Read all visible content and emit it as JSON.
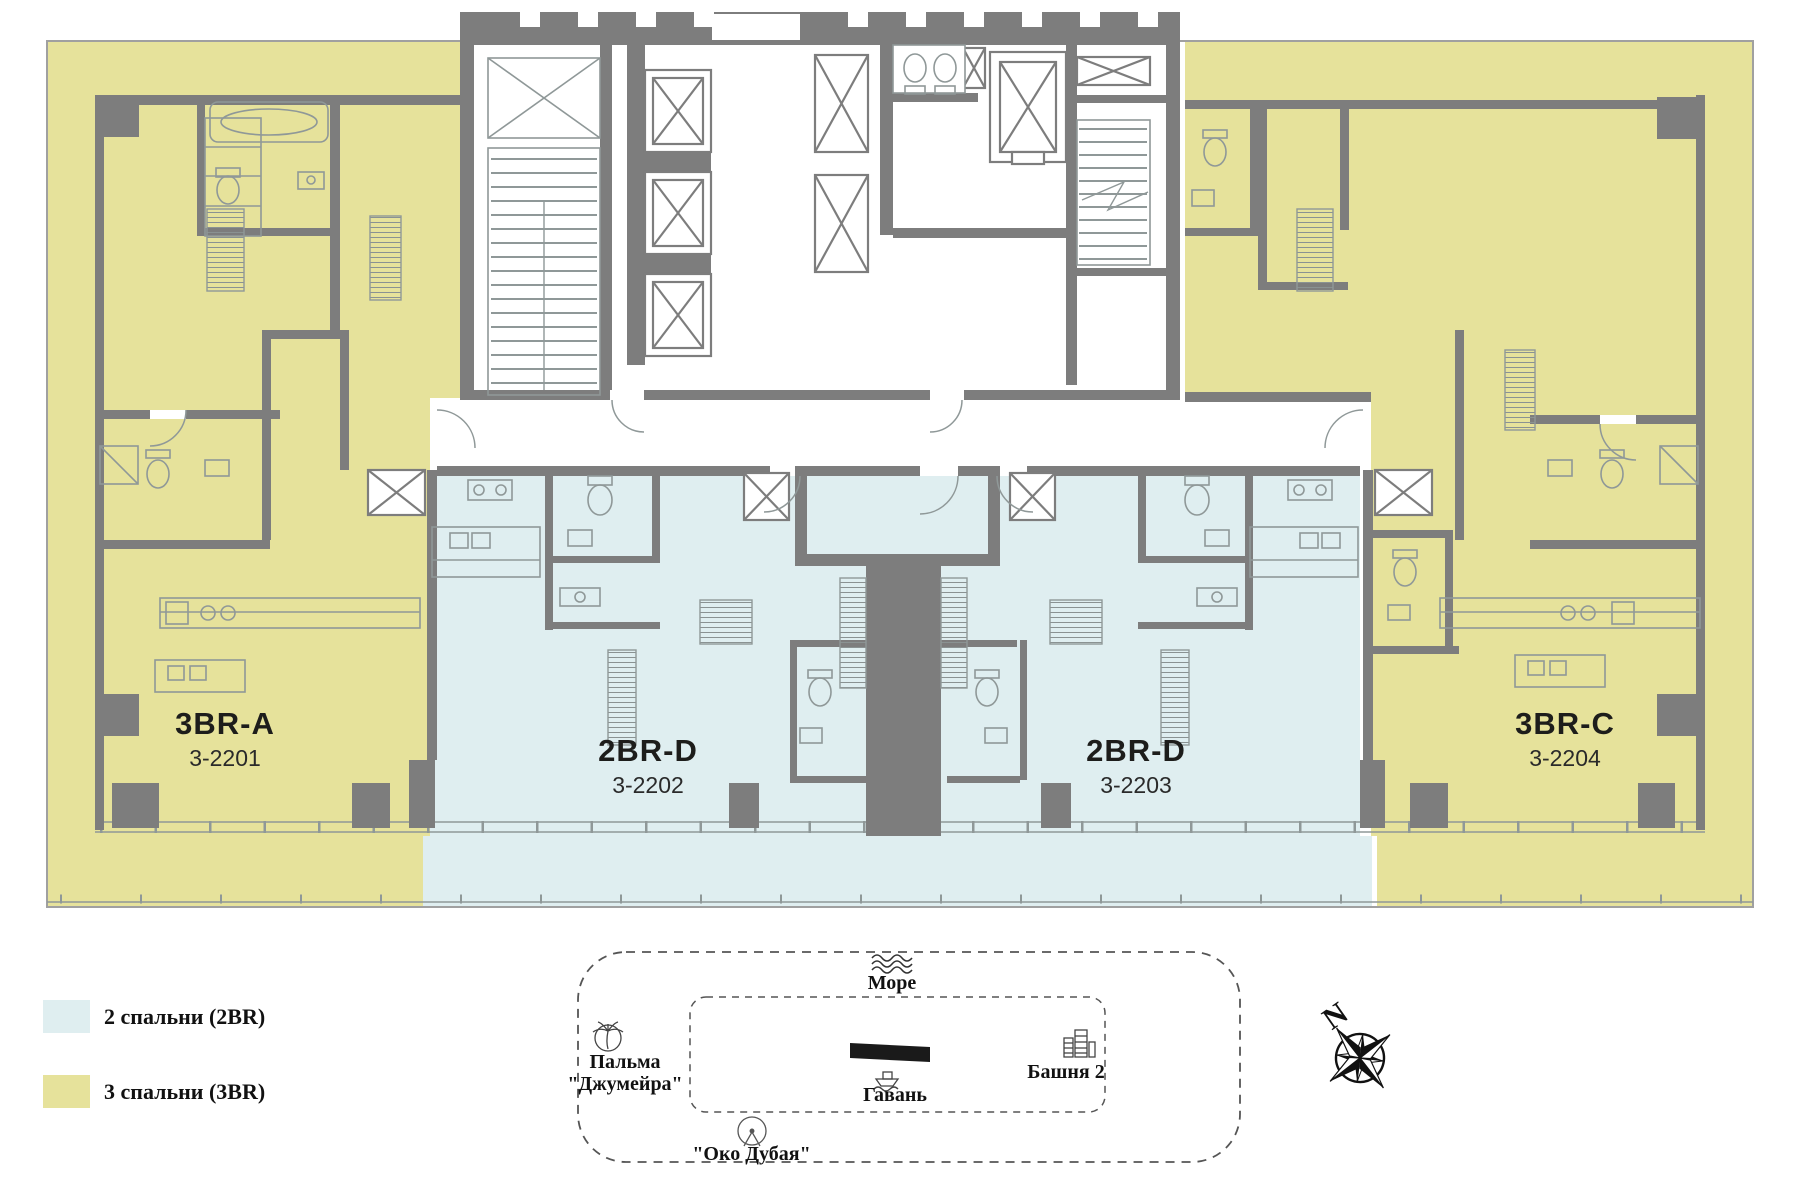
{
  "floor_plan": {
    "units": [
      {
        "type": "3BR-A",
        "number": "3-2201",
        "category": "3BR"
      },
      {
        "type": "2BR-D",
        "number": "3-2202",
        "category": "2BR"
      },
      {
        "type": "2BR-D",
        "number": "3-2203",
        "category": "2BR"
      },
      {
        "type": "3BR-C",
        "number": "3-2204",
        "category": "3BR"
      }
    ],
    "colors": {
      "two_bedroom_fill": "#dfeef0",
      "three_bedroom_fill": "#e6e29b",
      "wall": "#7d7d7d",
      "thin_line": "#8f9898"
    }
  },
  "legend": {
    "items": [
      {
        "label": "2 спальни (2BR)",
        "color": "#dfeef0"
      },
      {
        "label": "3 спальни (3BR)",
        "color": "#e6e29b"
      }
    ]
  },
  "site_map": {
    "sea_label": "Море",
    "palm_label_line1": "Пальма",
    "palm_label_line2": "\"Джумейра\"",
    "harbor_label": "Гавань",
    "tower_label": "Башня 2",
    "eye_label": "\"Око Дубая\"",
    "building_color": "#1a1a1a"
  },
  "compass": {
    "north_label": "N"
  }
}
